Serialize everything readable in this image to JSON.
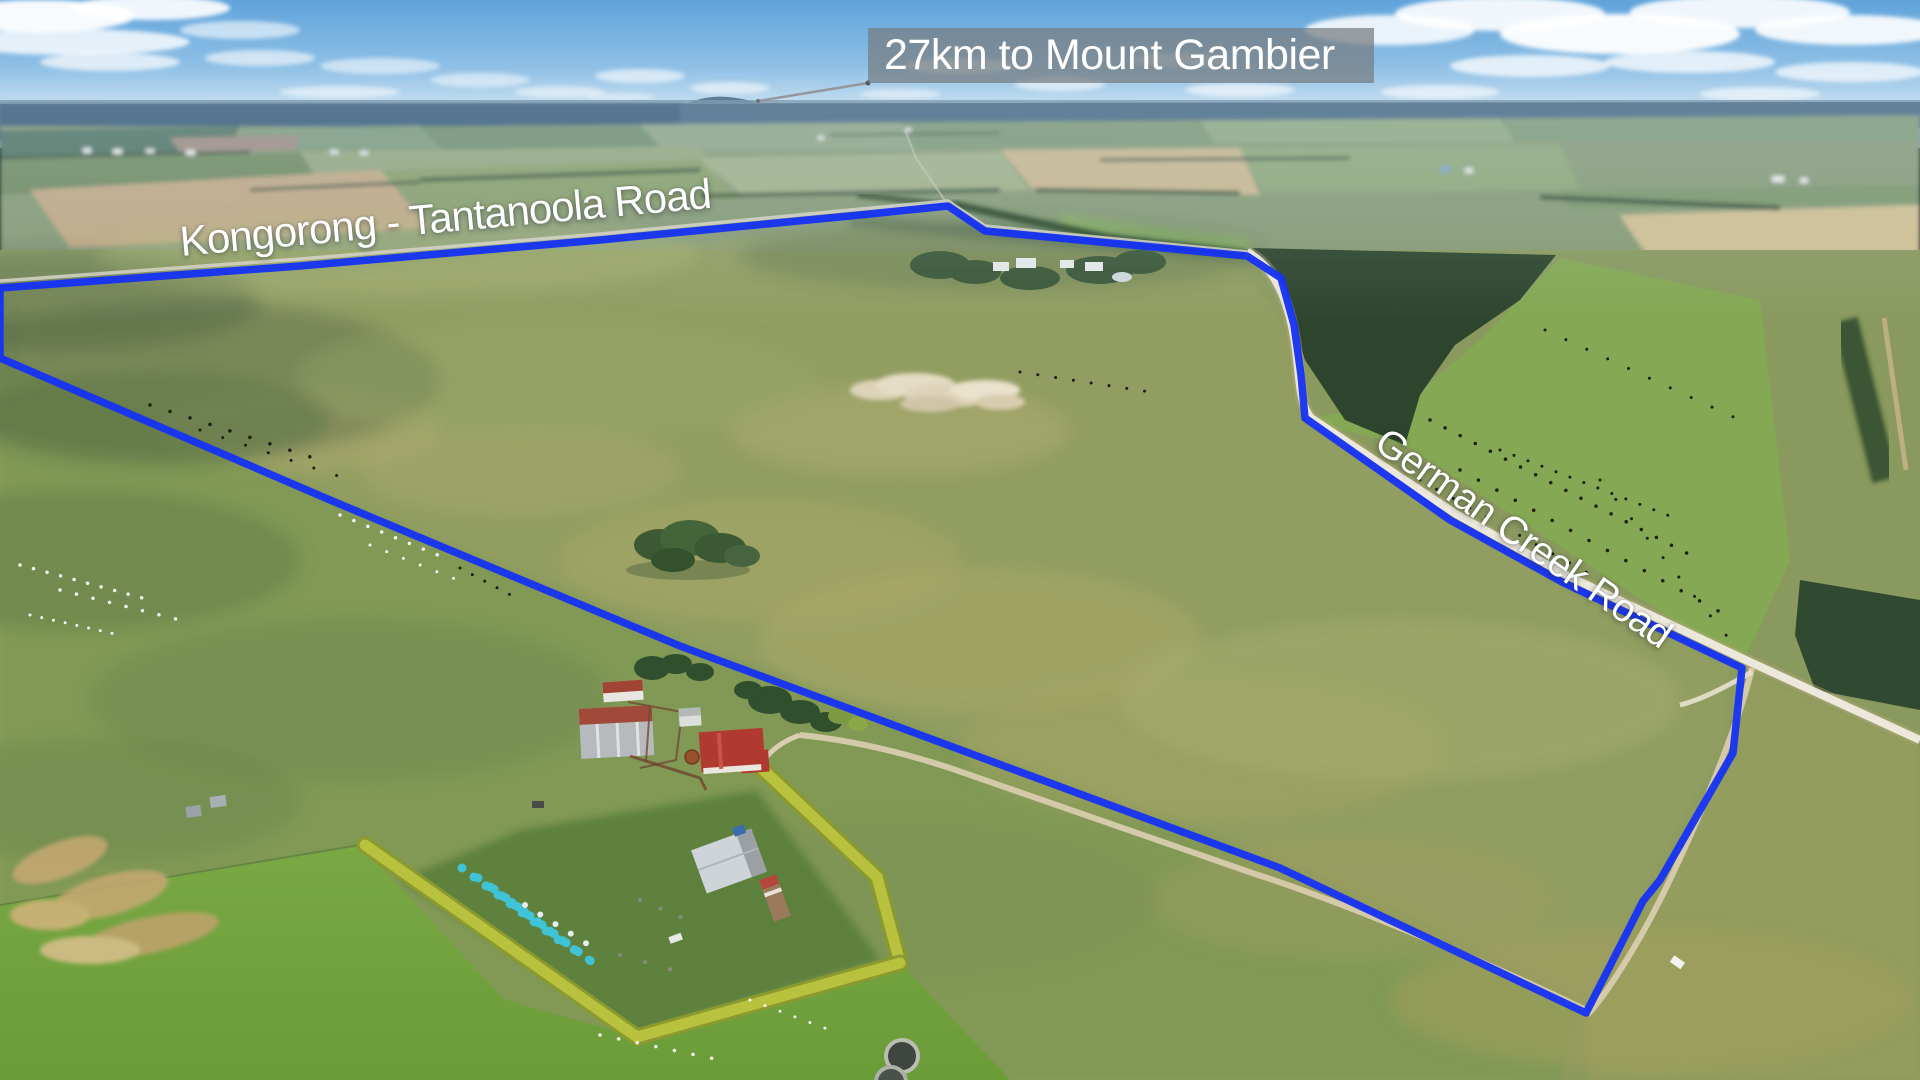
{
  "annotations": {
    "distance_callout": {
      "text": "27km to Mount Gambier"
    },
    "road_labels": [
      {
        "name": "Kongorong - Tantanoola Road"
      },
      {
        "name": "German Creek Road"
      }
    ]
  },
  "colors": {
    "boundary_blue": "#1733f2",
    "callout_background": "rgba(118,123,128,0.72)",
    "label_white": "#ffffff"
  }
}
